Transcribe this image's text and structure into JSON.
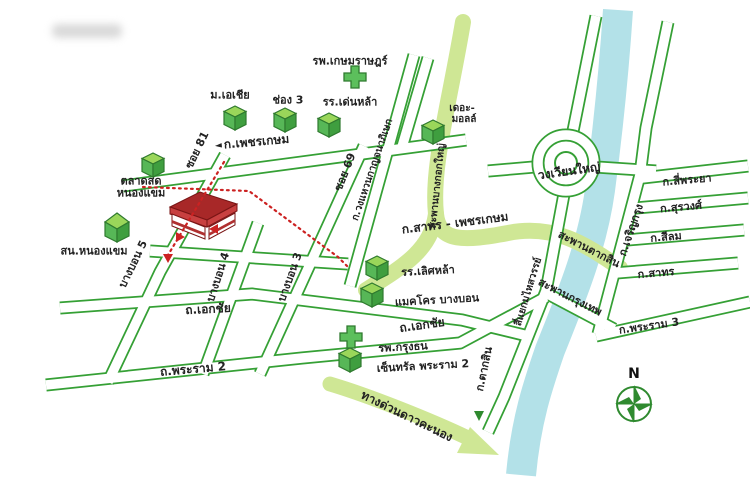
{
  "map": {
    "type": "location-map",
    "colors": {
      "road_outline_green": "#35a035",
      "highlight_band_green": "#cfe795",
      "river_blue": "#b3e1e8",
      "route_dotted_red": "#cc2222",
      "destination_building_red": "#a82828",
      "icon_green": "#57b757"
    },
    "labels": {
      "hospital_kasemrad": "รพ.เกษมราษฎร์",
      "univ_asia": "ม.เอเชีย",
      "channel3": "ช่อง 3",
      "school_denla": "รร.เด่นหล้า",
      "the_mall_1": "เดอะ-",
      "the_mall_2": "มอลล์",
      "road_phetkasem": "ก.เพชรเกษม",
      "phetkasem_arrow": "◄",
      "soi81": "ซอย 81",
      "soi69": "ซอย 69",
      "ring_road": "ก.วงแหวนกาญจนาภิเษก",
      "market_1": "ตลาดสด",
      "market_2": "หนองแขม",
      "police_nongkhaem": "สน.หนองแขม",
      "bangbon5": "บางบอน 5",
      "bangbon4": "บางบอน 4",
      "bangbon3": "บางบอน 3",
      "road_ekkachai": "ถ.เอกชัย",
      "road_rama2": "ถ.พระราม 2",
      "band_sathorn_phetkasem": "ก.สาทร - เพชรเกษม",
      "bridge_bangkokyai": "สะพานบางกอกใหญ่",
      "wongwian_yai": "วงเวียนใหญ่",
      "bridge_taksin": "สะพานตากสิน",
      "bridge_krungthep": "สะพานกรุงเทพ",
      "road_charoenkrung": "ก.เจริญกรุง",
      "road_siphraya": "ก.สี่พระยา",
      "road_surawong": "ก.สุรวงศ์",
      "road_silom": "ก.สีลม",
      "road_sathorn": "ก.สาทร",
      "road_rama3": "ก.พระราม 3",
      "junction_mahaisawan": "สี่แยกมไหสวรรย์",
      "road_taksin": "ก.ตากสิน",
      "school_lertlah": "รร.เลิศหล้า",
      "makro_bangbon": "แมคโคร บางบอน",
      "hospital_krungthon": "รพ.กรุงธน",
      "central_rama2": "เซ็นทรัล พระราม 2",
      "expressway_daokanong": "ทางด่วนดาวคะนอง",
      "compass_n": "N"
    }
  }
}
